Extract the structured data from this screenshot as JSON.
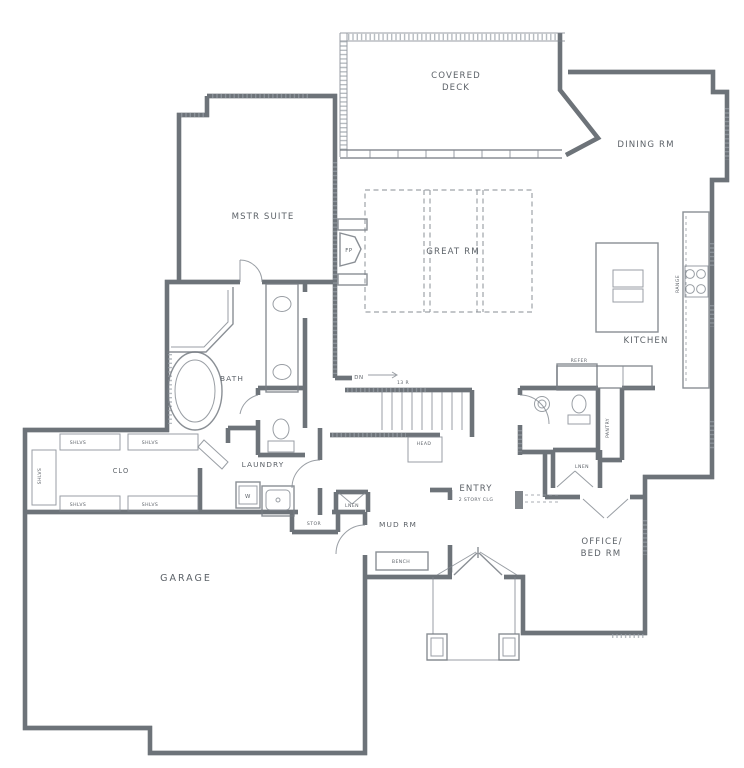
{
  "colors": {
    "ink": "#6a7076",
    "fixture_line": "#757b82",
    "hatch": "#99a0a7",
    "label_text": "#4e545b",
    "paper": "#ffffff"
  },
  "rooms": {
    "covered_deck": {
      "line1": "COVERED",
      "line2": "DECK"
    },
    "dining": {
      "label": "DINING RM"
    },
    "mstr_suite": {
      "label": "MSTR SUITE"
    },
    "great_rm": {
      "label": "GREAT RM"
    },
    "kitchen": {
      "label": "KITCHEN"
    },
    "bath": {
      "label": "BATH"
    },
    "clo": {
      "label": "CLO"
    },
    "laundry": {
      "label": "LAUNDRY"
    },
    "garage": {
      "label": "GARAGE"
    },
    "mud_rm": {
      "label": "MUD RM"
    },
    "entry": {
      "label": "ENTRY",
      "sub": "2 STORY CLG"
    },
    "office": {
      "line1": "OFFICE/",
      "line2": "BED RM"
    }
  },
  "features": {
    "fireplace": "FP",
    "stairs_down": "DN",
    "stairs_note": "13 R",
    "washer": "W",
    "refrigerator": "REFER",
    "pantry": "PANTRY",
    "range": "RANGE",
    "bench": "BENCH",
    "linen": "LNEN",
    "storage": "STOR",
    "head": "HEAD",
    "shelves": "SHLVS"
  }
}
